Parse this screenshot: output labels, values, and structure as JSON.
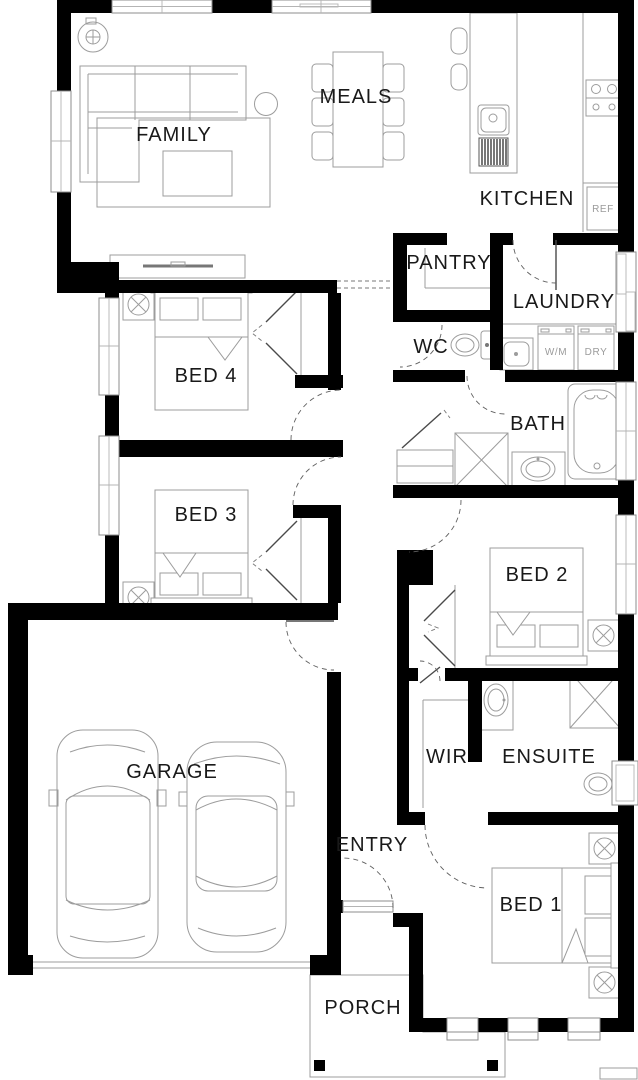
{
  "floor_plan": {
    "rooms": {
      "family": {
        "label": "FAMILY"
      },
      "meals": {
        "label": "MEALS"
      },
      "kitchen": {
        "label": "KITCHEN"
      },
      "pantry": {
        "label": "PANTRY"
      },
      "laundry": {
        "label": "LAUNDRY"
      },
      "wc": {
        "label": "WC"
      },
      "bed4": {
        "label": "BED 4"
      },
      "bath": {
        "label": "BATH"
      },
      "bed3": {
        "label": "BED 3"
      },
      "bed2": {
        "label": "BED 2"
      },
      "garage": {
        "label": "GARAGE"
      },
      "wir": {
        "label": "WIR"
      },
      "ensuite": {
        "label": "ENSUITE"
      },
      "entry": {
        "label": "ENTRY"
      },
      "bed1": {
        "label": "BED 1"
      },
      "porch": {
        "label": "PORCH"
      }
    },
    "appliances": {
      "fridge": {
        "label": "REF"
      },
      "washing_machine": {
        "label": "W/M"
      },
      "dryer": {
        "label": "DRY"
      }
    },
    "colors": {
      "wall": "#000000",
      "floor": "#ffffff",
      "furniture_line": "#9c9c9c",
      "room_label": "#191919",
      "appliance_label": "#9b9b9b"
    }
  }
}
